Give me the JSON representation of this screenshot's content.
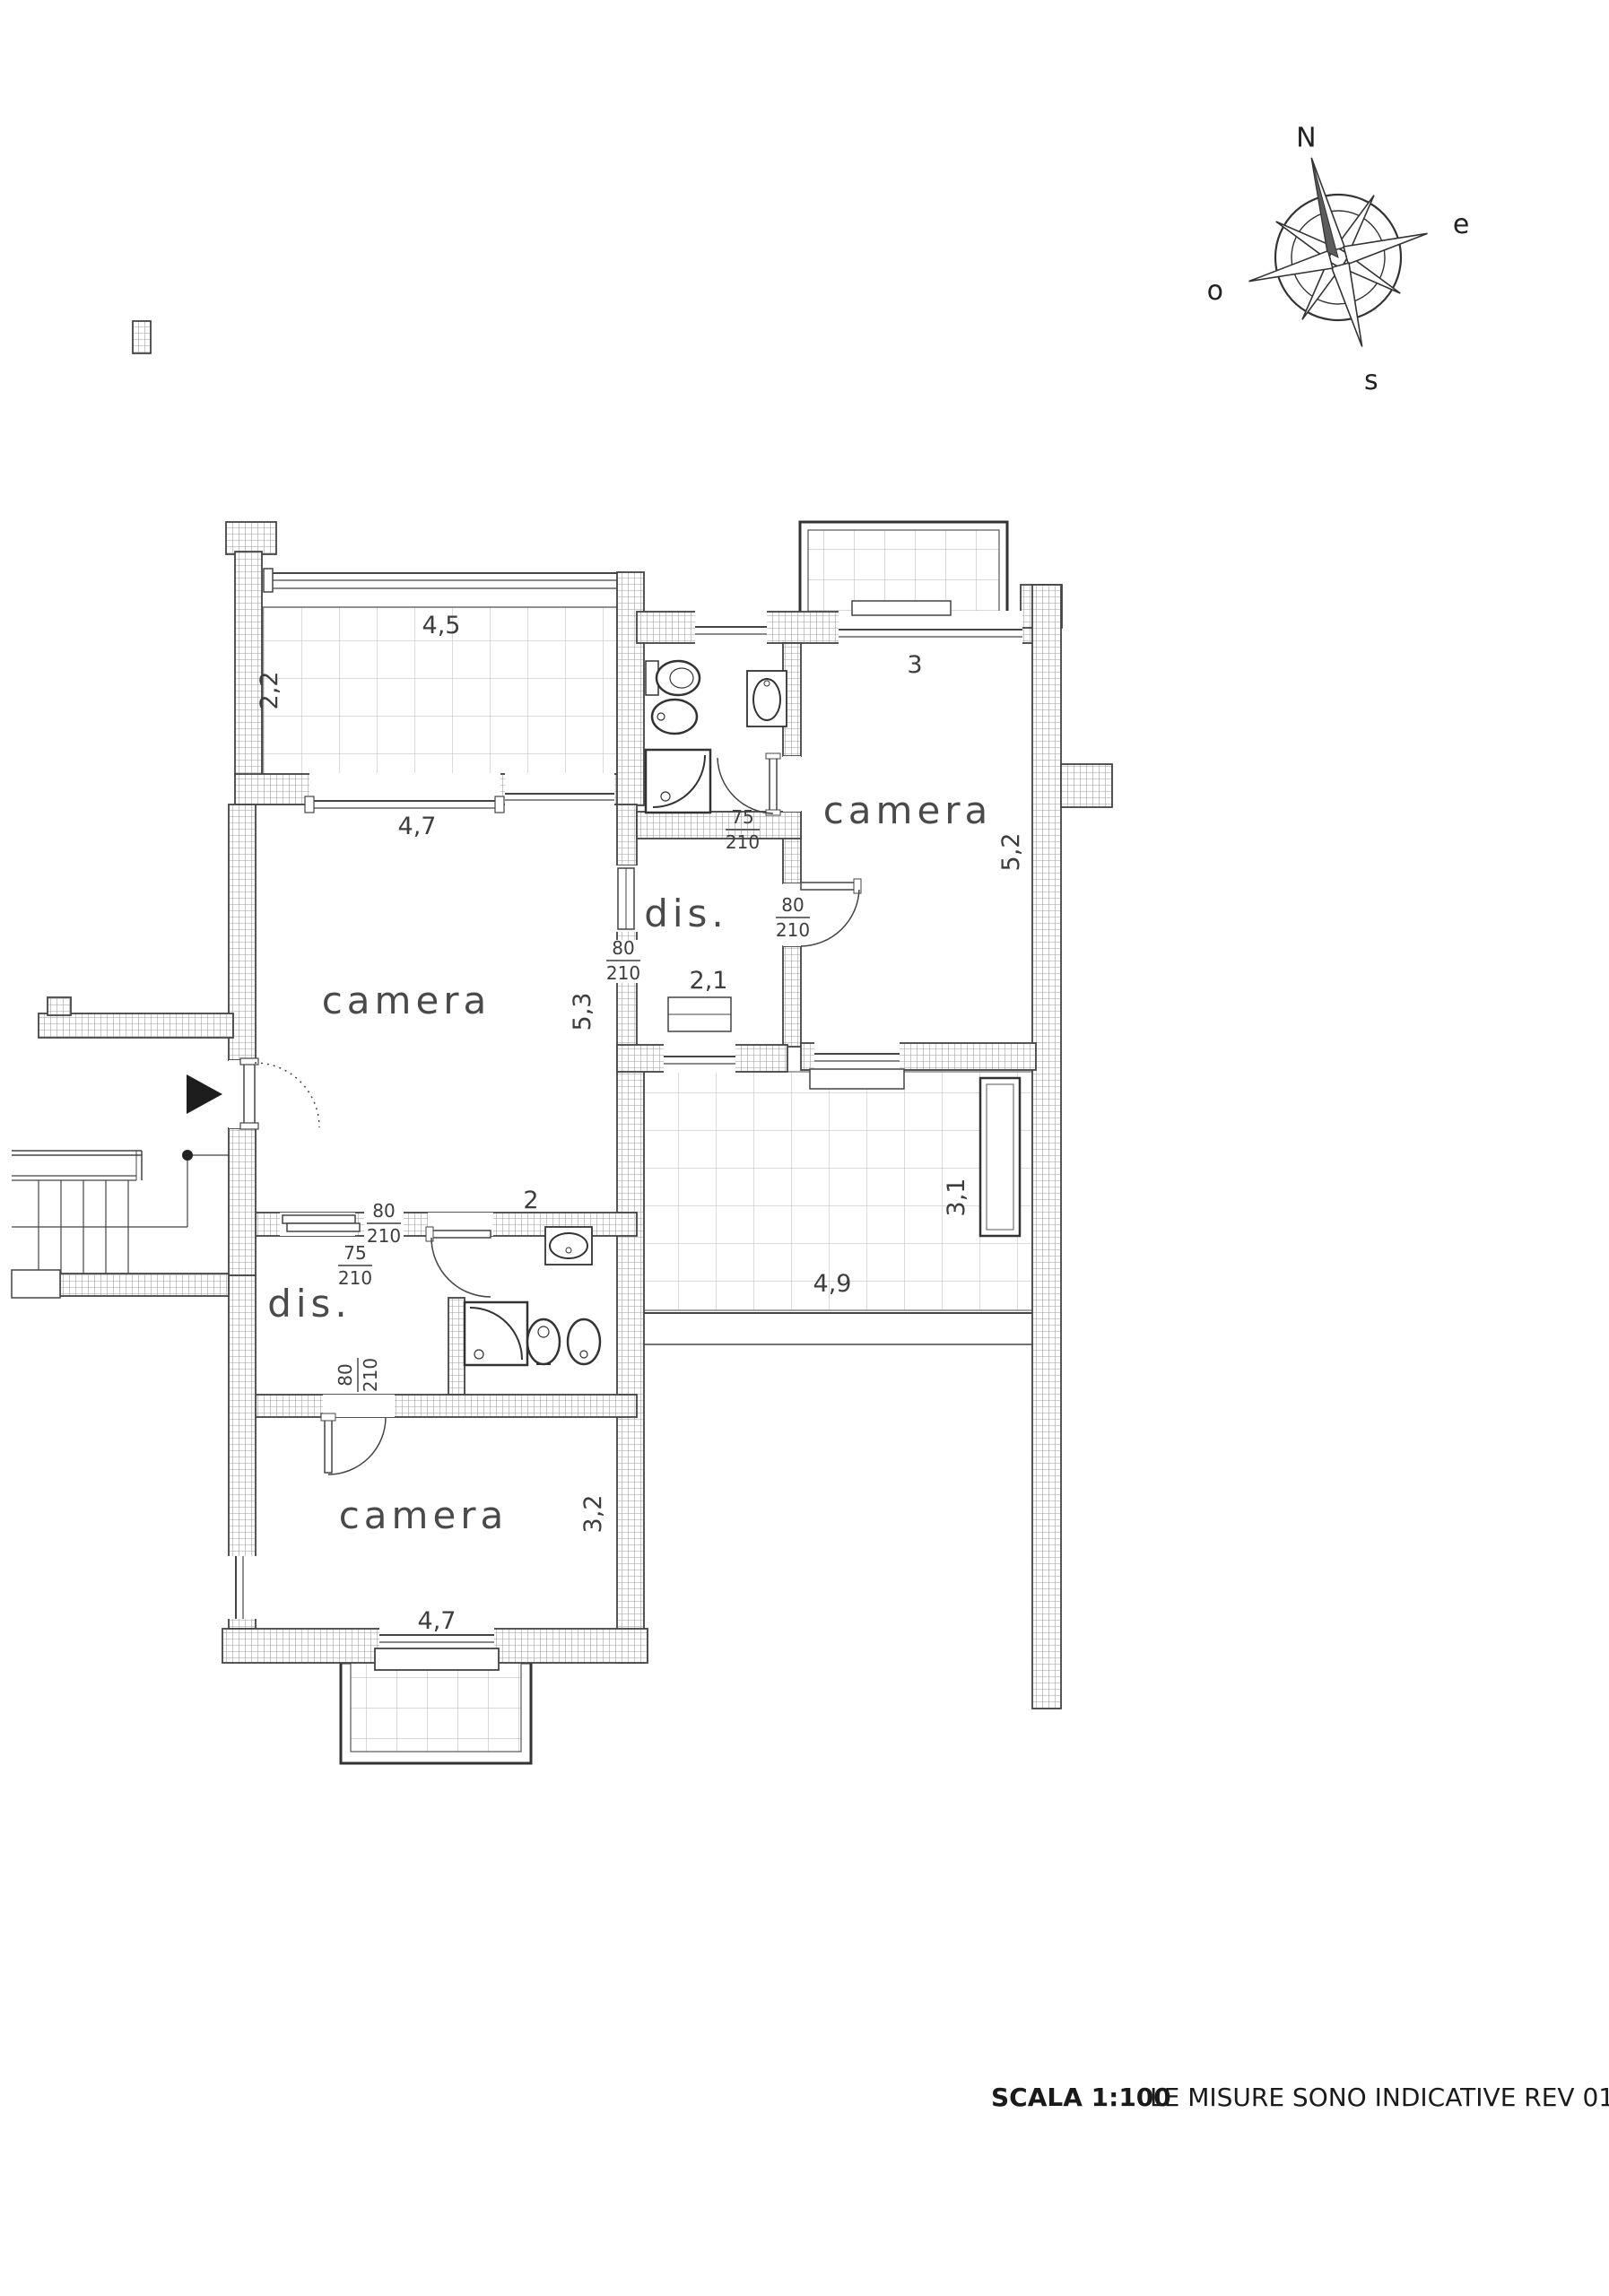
{
  "compass": {
    "north": "N",
    "east": "e",
    "south": "s",
    "west": "o"
  },
  "rooms": {
    "camera_left": {
      "label": "camera",
      "width": "4,7",
      "height": "5,3"
    },
    "camera_right": {
      "label": "camera",
      "width_top": "3",
      "height": "5,2"
    },
    "camera_bottom": {
      "label": "camera",
      "width": "4,7",
      "height": "3,2"
    },
    "dis_upper": {
      "label": "dis.",
      "width": "2,1"
    },
    "dis_lower": {
      "label": "dis.",
      "width": "2"
    },
    "balcony_top": {
      "width": "4,5",
      "height": "2,2"
    },
    "terrace": {
      "width": "4,9",
      "height": "3,1"
    }
  },
  "doors": {
    "bath_upper": {
      "num": "75",
      "den": "210"
    },
    "camera_right": {
      "num": "80",
      "den": "210"
    },
    "camera_left_flush": {
      "num": "80",
      "den": "210"
    },
    "bath_lower": {
      "num": "75",
      "den": "210"
    },
    "camera_left_sliding": {
      "num": "80",
      "den": "210"
    },
    "camera_bottom": {
      "num": "80",
      "den": "210"
    }
  },
  "footer": {
    "scale": "SCALA 1:100",
    "note": "LE MISURE SONO INDICATIVE  REV 01/2018"
  }
}
